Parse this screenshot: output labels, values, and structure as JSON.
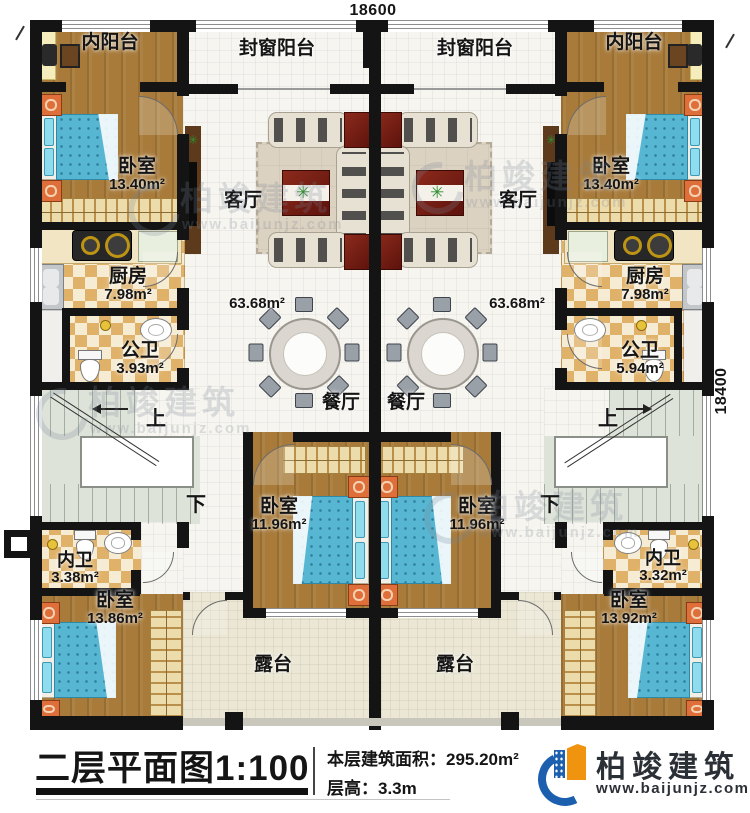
{
  "colors": {
    "wall": "#141414",
    "wood": "#a87b3b",
    "tile_light": "#f6f5f0",
    "terrace": "#ebe7d4",
    "checker_tan": "#e0b269",
    "checker_cream": "#f6ecd4",
    "bed_blue": "#57b7d3",
    "nightstand_orange": "#df6f3a",
    "stairs": "#dde3d9",
    "brand_blue": "#1b5fae",
    "brand_orange": "#f0930f"
  },
  "dimensions": {
    "top": "18600",
    "right": "18400"
  },
  "stairs": {
    "up": "上",
    "down": "下"
  },
  "rooms": {
    "enclosed_balcony_left": {
      "name": "封窗阳台"
    },
    "enclosed_balcony_right": {
      "name": "封窗阳台"
    },
    "inner_balcony_left": {
      "name": "内阳台"
    },
    "inner_balcony_right": {
      "name": "内阳台"
    },
    "bedroom_top_left": {
      "name": "卧室",
      "area": "13.40m²"
    },
    "bedroom_top_right": {
      "name": "卧室",
      "area": "13.40m²"
    },
    "living_left": {
      "name": "客厅",
      "area": "63.68m²"
    },
    "living_right": {
      "name": "客厅",
      "area": "63.68m²"
    },
    "kitchen_left": {
      "name": "厨房",
      "area": "7.98m²"
    },
    "kitchen_right": {
      "name": "厨房",
      "area": "7.98m²"
    },
    "public_bath_left": {
      "name": "公卫",
      "area": "3.93m²"
    },
    "public_bath_right": {
      "name": "公卫",
      "area": "5.94m²"
    },
    "dining_left": {
      "name": "餐厅"
    },
    "dining_right": {
      "name": "餐厅"
    },
    "bedroom_mid_left": {
      "name": "卧室",
      "area": "11.96m²"
    },
    "bedroom_mid_right": {
      "name": "卧室",
      "area": "11.96m²"
    },
    "ensuite_left": {
      "name": "内卫",
      "area": "3.38m²"
    },
    "ensuite_right": {
      "name": "内卫",
      "area": "3.32m²"
    },
    "bedroom_bottom_left": {
      "name": "卧室",
      "area": "13.86m²"
    },
    "bedroom_bottom_right": {
      "name": "卧室",
      "area": "13.92m²"
    },
    "terrace_left": {
      "name": "露台"
    },
    "terrace_right": {
      "name": "露台"
    }
  },
  "icons": {
    "plant": "✳"
  },
  "title_block": {
    "plan_title": "二层平面图1:100",
    "floor_area": "本层建筑面积：295.20m²",
    "floor_height": "层高：3.3m",
    "brand_name": "柏竣建筑",
    "brand_url": "www.baijunjz.com"
  },
  "watermark": {
    "brand": "柏竣建筑",
    "url": "www.baijunjz.com"
  }
}
